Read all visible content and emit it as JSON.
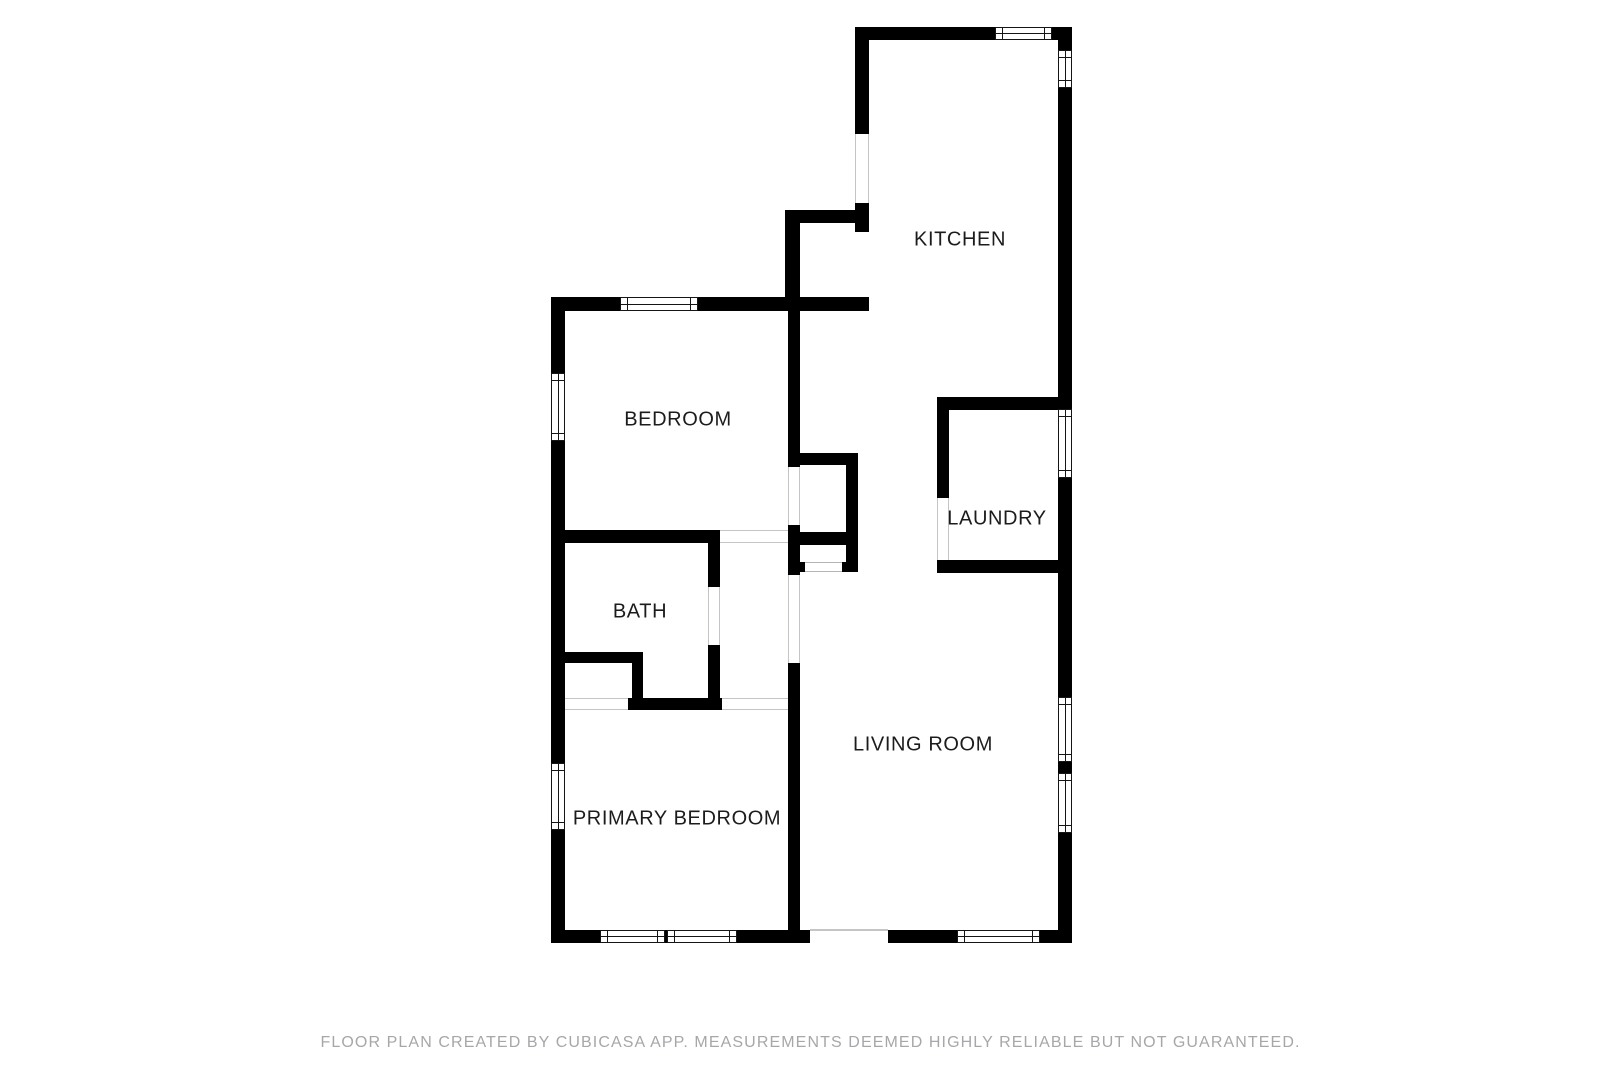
{
  "title": "Floor plan",
  "rooms": {
    "kitchen": "KITCHEN",
    "bedroom": "BEDROOM",
    "laundry": "LAUNDRY",
    "bath": "BATH",
    "living_room": "LIVING ROOM",
    "primary_bedroom": "PRIMARY BEDROOM"
  },
  "footer": {
    "text": "FLOOR PLAN CREATED BY CUBICASA APP. MEASUREMENTS DEEMED HIGHLY RELIABLE BUT NOT GUARANTEED."
  },
  "colors": {
    "wall": "#000000",
    "background": "#ffffff",
    "label": "#1c1c1c",
    "door_line": "#c5c5c8",
    "window_line": "#151515",
    "footer_text": "#a7a7aa"
  }
}
